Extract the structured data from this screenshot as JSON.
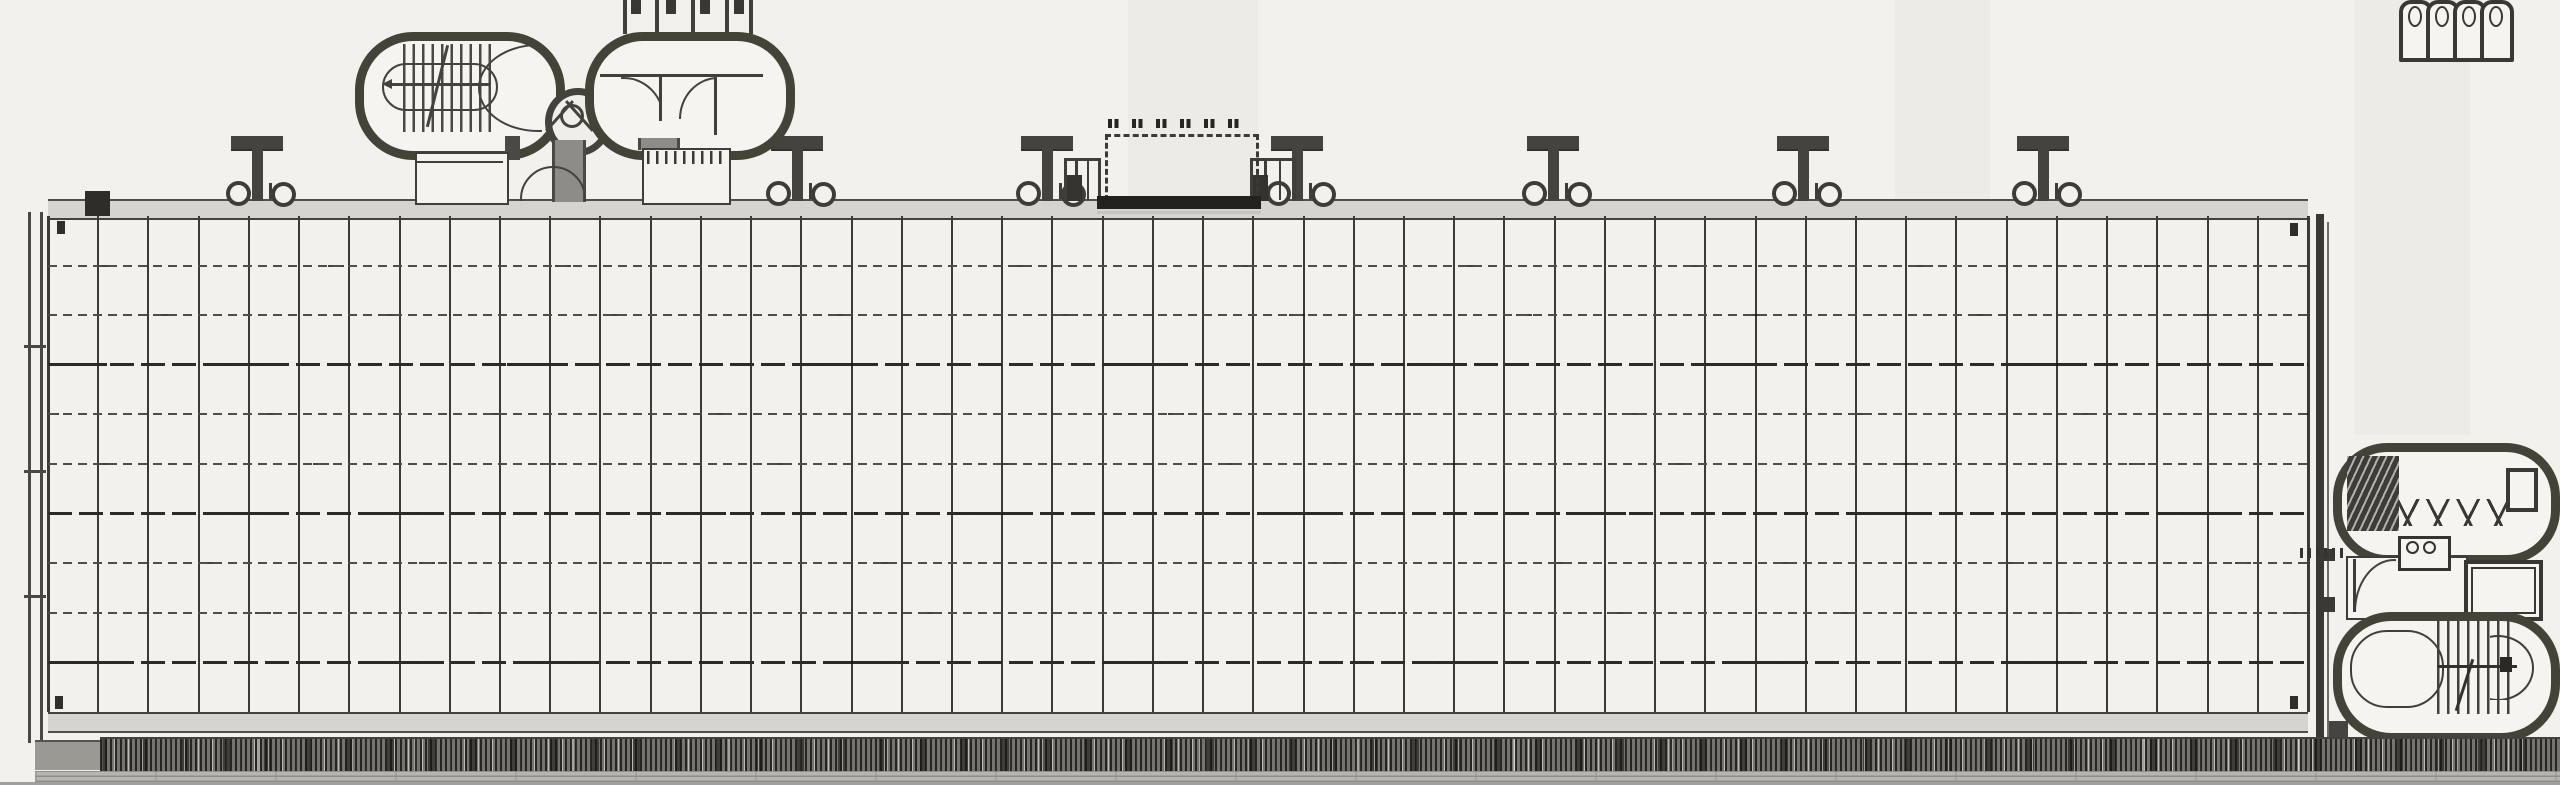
{
  "drawing": {
    "kind": "architectural-floor-plan",
    "visible_text": "",
    "colors": {
      "paper": "#f2f1ee",
      "ink_dark": "#3a3834",
      "ink_mid": "#4a4844",
      "band_fill": "#d6d4d0",
      "pod_outline": "#454238",
      "hatch_base": "#76746f",
      "under_band": "#b7b5b1"
    },
    "grid": {
      "x": 48,
      "y": 216,
      "width": 2260,
      "height": 496,
      "columns": 45,
      "rows": 10,
      "heavy_row_indices": [
        3,
        6,
        9
      ],
      "vertical_line_color": "#3b3a36",
      "dashed_row_color": "#504e49",
      "heavy_row_color": "#2c2b27"
    },
    "bands": {
      "top_y": 199,
      "bottom_y": 712,
      "height": 17
    },
    "masts": {
      "positions_x": [
        257,
        797,
        1047,
        1297,
        1553,
        1803,
        2043
      ],
      "crossbar_width": 52,
      "crossbar_y": 136,
      "stem_bottom_y": 201,
      "color": "#454340",
      "flank_circle_offset": 23
    },
    "fences": [
      {
        "x": 1064,
        "width": 36,
        "posts": 4,
        "blob": true
      },
      {
        "x": 1250,
        "width": 45,
        "posts": 4,
        "blob": true
      }
    ],
    "corner_marks": [
      [
        57,
        221
      ],
      [
        2290,
        223
      ],
      [
        55,
        696
      ],
      [
        2290,
        696
      ]
    ],
    "wall_tick_ys": [
      345,
      470,
      595
    ],
    "wc_posts_x": [
      623,
      655,
      691,
      725,
      749
    ],
    "wc_marks_x": [
      631,
      666,
      700,
      734
    ],
    "stalls_x": [
      2399,
      2426,
      2453,
      2480
    ],
    "streaks": [
      {
        "x": 1128,
        "width": 130,
        "height": 205
      },
      {
        "x": 1895,
        "width": 95,
        "height": 215
      },
      {
        "x": 2355,
        "width": 115,
        "height": 435
      }
    ],
    "canopy": {
      "x": 1105,
      "y": 134,
      "width": 148,
      "height": 64,
      "glyph_pairs": 6
    }
  }
}
